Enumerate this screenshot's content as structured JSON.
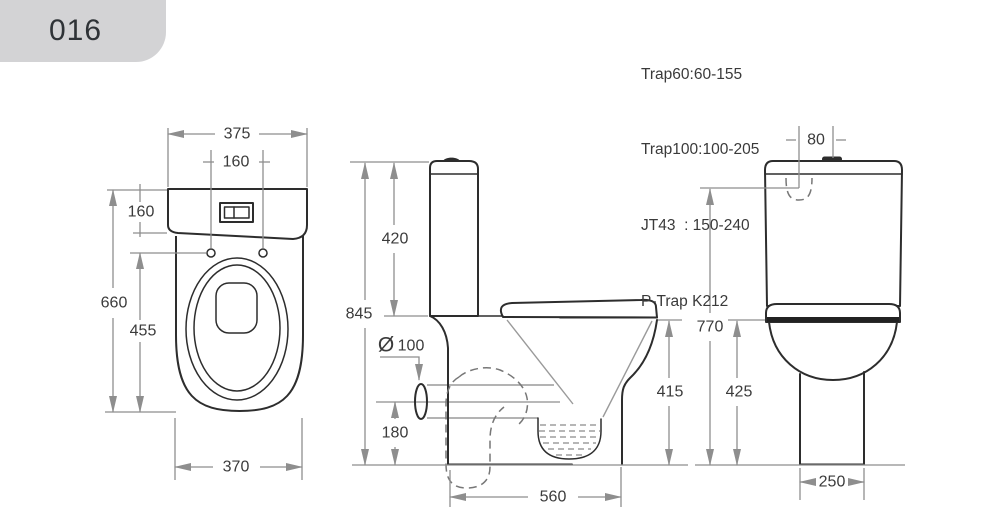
{
  "title": {
    "code": "016"
  },
  "specs": {
    "line1": "Trap60:60-155",
    "line2": "Trap100:100-205",
    "line3": "JT43  : 150-240",
    "line4": "P-Trap K212"
  },
  "front_view": {
    "tank_width": "375",
    "hole_spacing": "160",
    "tank_height": "160",
    "overall_height": "660",
    "bowl_height": "455",
    "base_width": "370"
  },
  "side_view": {
    "overall_height": "845",
    "cistern_height": "420",
    "outlet_symbol": "Ø",
    "outlet_diameter": "100",
    "outlet_height": "180",
    "overall_depth": "560",
    "bowl_height": "415"
  },
  "back_view": {
    "inlet_offset": "80",
    "inlet_height": "770",
    "rim_height": "425",
    "base_width": "250"
  },
  "colors": {
    "line": "#2d2d2d",
    "dimension": "#8e8e8e",
    "badge_bg": "#d3d3d5"
  }
}
